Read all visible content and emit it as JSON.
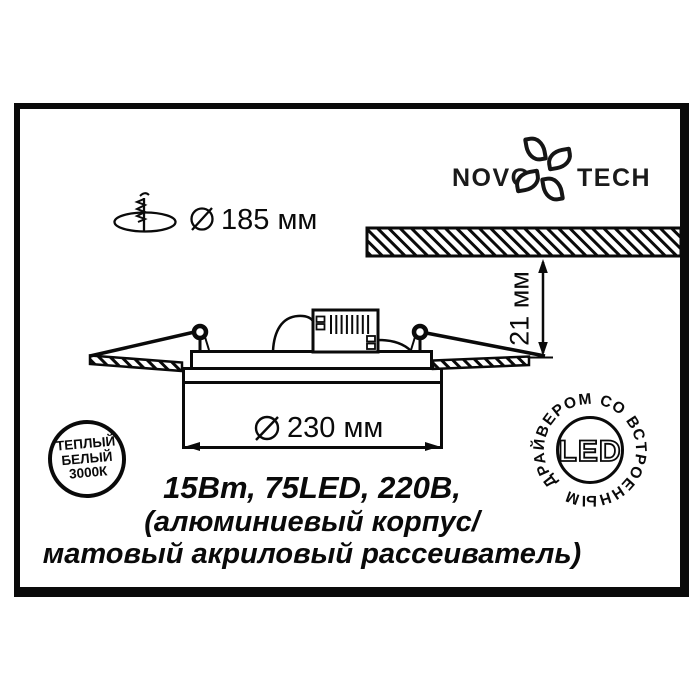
{
  "colors": {
    "ink": "#0a0a0a",
    "background": "#ffffff"
  },
  "logo": {
    "left": "NOVO",
    "right": "TECH"
  },
  "cutout_dimension": {
    "label": "185 мм"
  },
  "recess_depth": {
    "label": "21 мм"
  },
  "body_diameter": {
    "label": "230 мм"
  },
  "specs": {
    "line1": "15Вт, 75LED, 220В,",
    "line2": "(алюминиевый корпус/",
    "line3": "матовый акриловый рассеиватель)"
  },
  "badge_warm_white": {
    "line1": "ТЕПЛЫЙ",
    "line2": "БЕЛЫЙ",
    "line3": "3000К"
  },
  "badge_led": {
    "ring": "ДРАЙВЕРОМ СО ВСТРОЕННЫМ",
    "center": "LED"
  }
}
